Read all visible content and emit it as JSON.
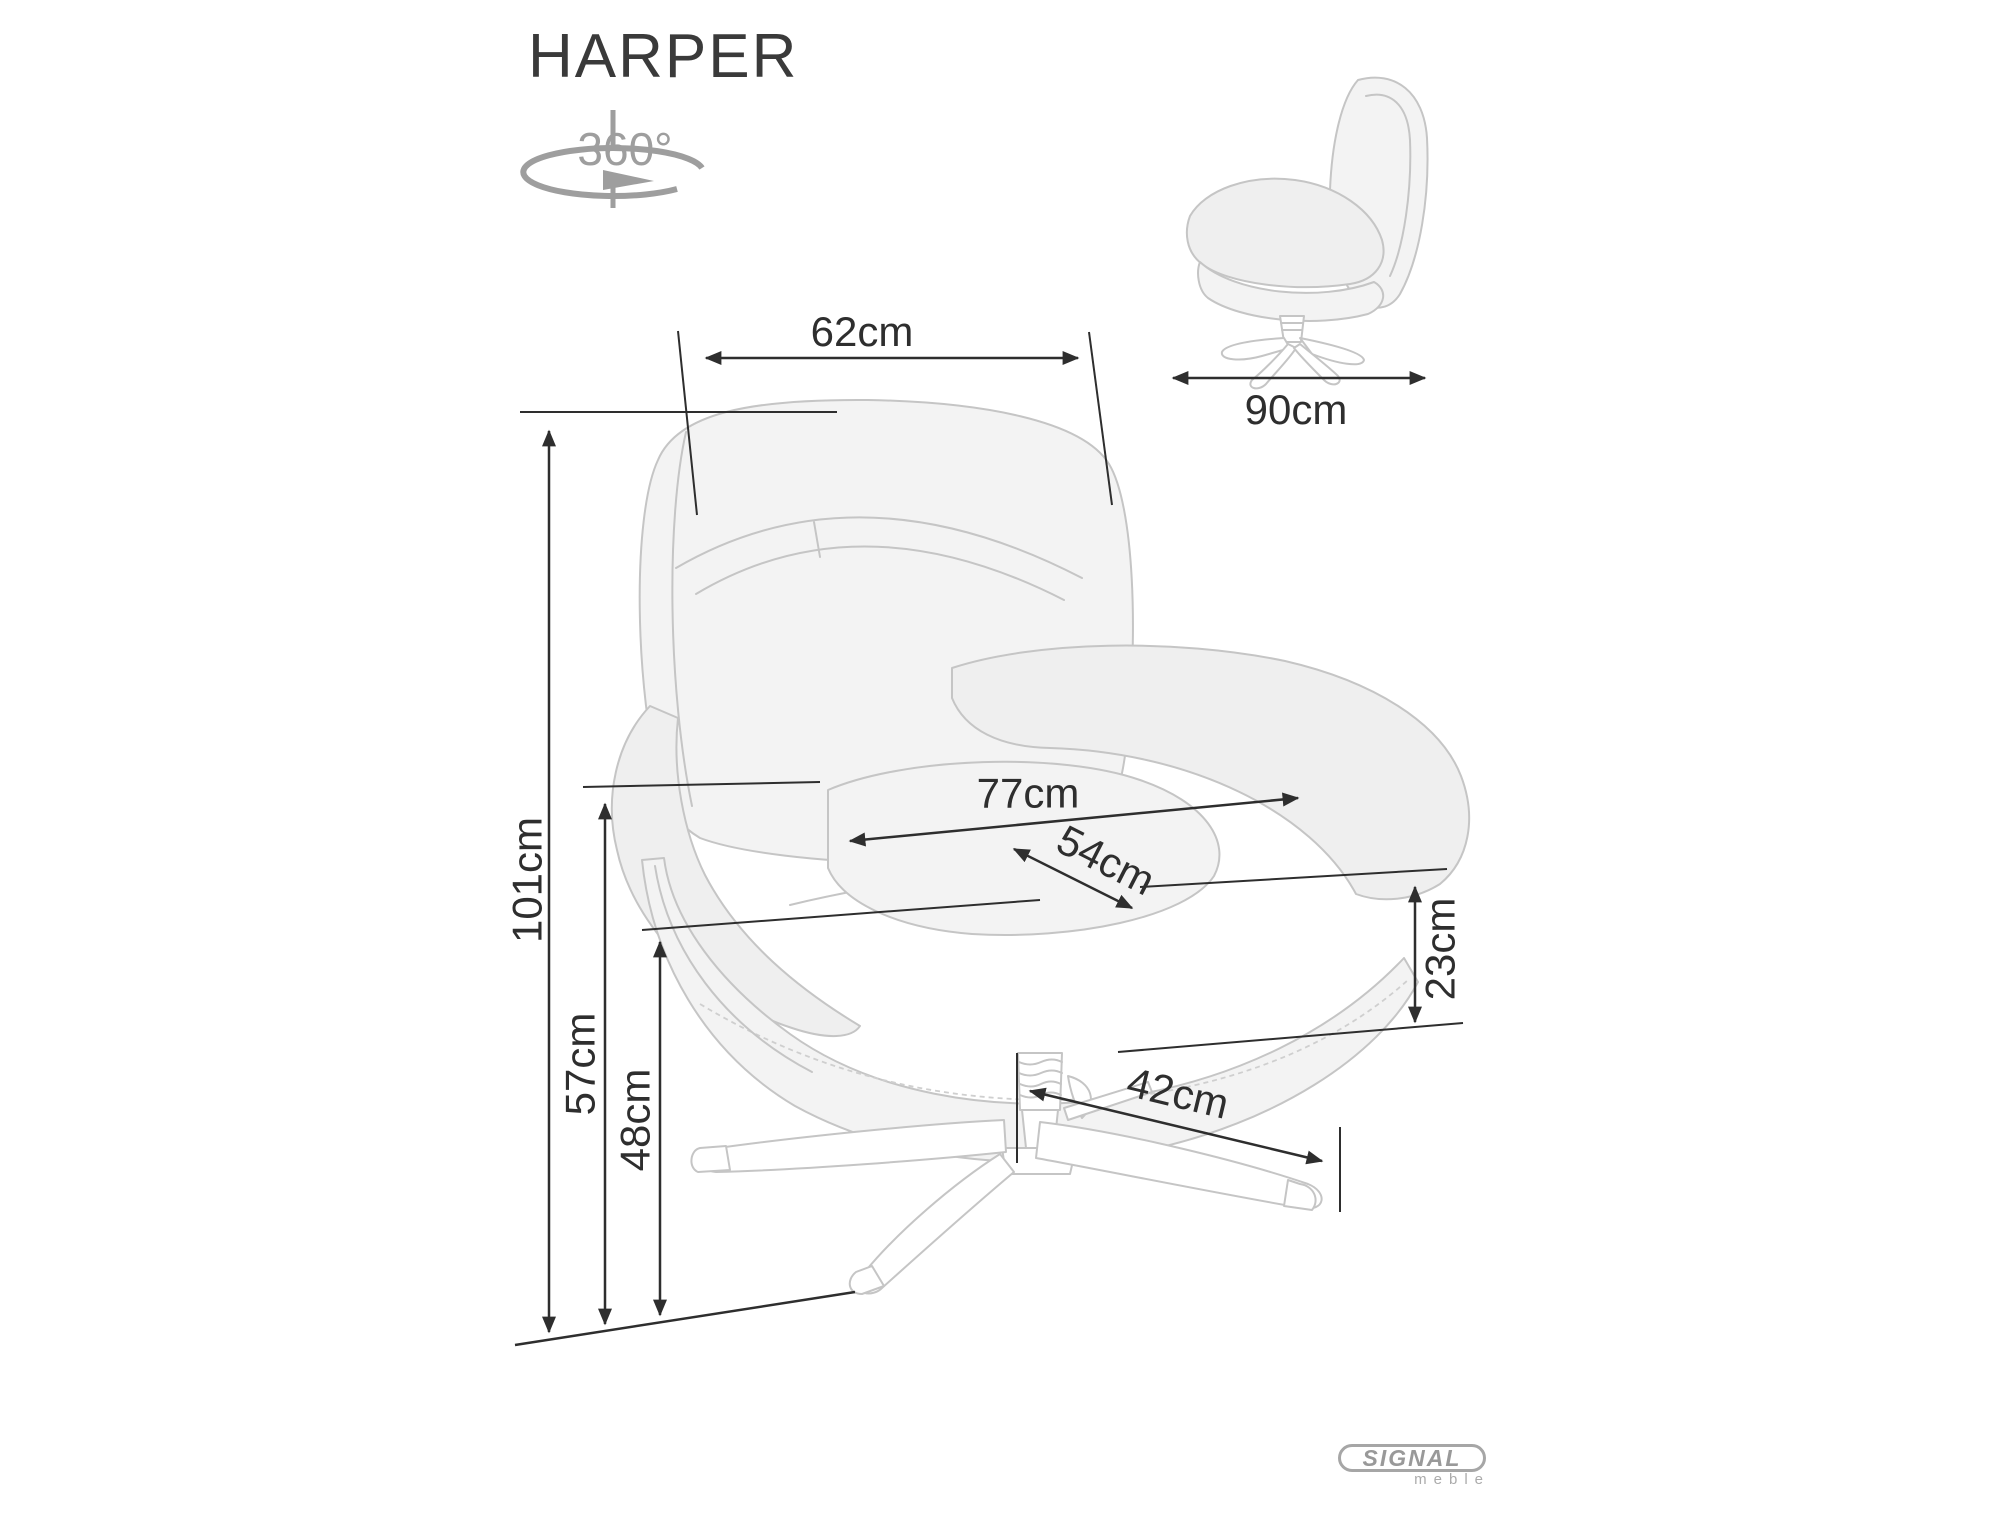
{
  "title": "HARPER",
  "rotation_icon": {
    "label": "360°"
  },
  "dimensions": {
    "backrest_width": "62cm",
    "depth": "90cm",
    "height": "101cm",
    "overall_width": "77cm",
    "seat_width": "54cm",
    "cushion_height": "23cm",
    "armrest_height": "57cm",
    "seat_height": "48cm",
    "base_span": "42cm"
  },
  "logo": {
    "brand": "SIGNAL",
    "sub": "meble"
  },
  "colors": {
    "dimension_ink": "#2e2e2e",
    "sketch_line": "#c5c5c5",
    "icon_gray": "#9e9e9e"
  }
}
